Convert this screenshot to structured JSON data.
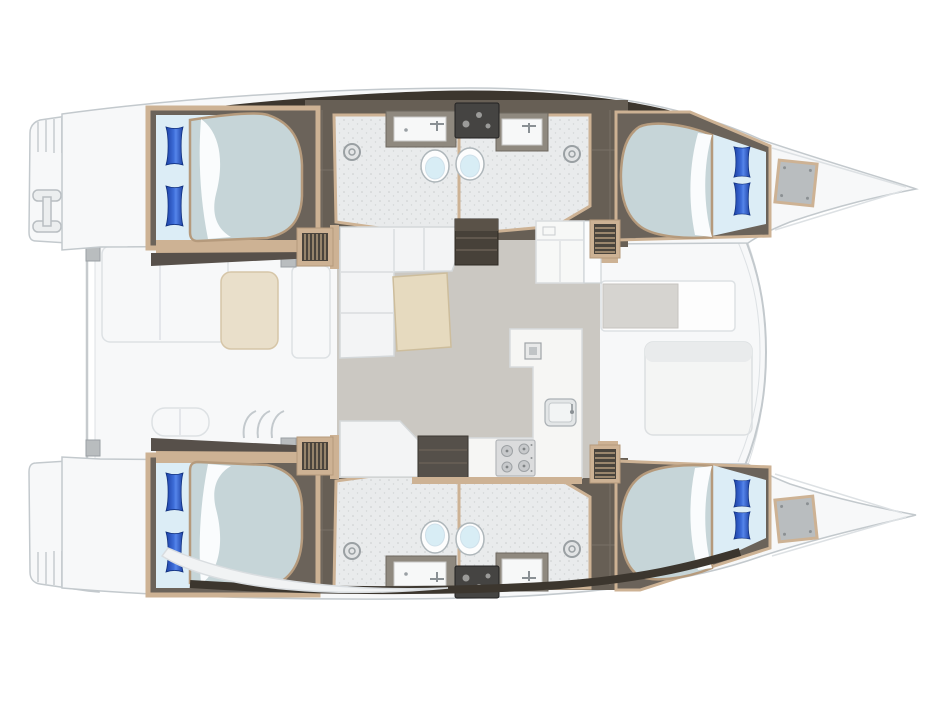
{
  "palette": {
    "bg": "#ffffff",
    "deck": "#f7f8f9",
    "deck2": "#f1f3f4",
    "outline": "#c3c9cd",
    "outline_soft": "#dde1e4",
    "hullstrip": "#3c362e",
    "floor_dark": "#675f55",
    "floor_dark2": "#57504a",
    "wood": "#cdb294",
    "wood_dark": "#b59a7c",
    "bath_floor": "#e9ebec",
    "fixture_frame": "#8f897f",
    "sink_white": "#f7f8f8",
    "toilet_white": "#fdfdfd",
    "toilet_bowl": "#d8edf5",
    "appliance_dark": "#454442",
    "knob_gray": "#9b9b99",
    "bed_mattress": "#c6d5d8",
    "bed_mattress_edge": "#9fb4b8",
    "bed_head": "#dcedf6",
    "pillow_dark": "#1c41a4",
    "pillow_mid": "#3d6cd8",
    "pillow_light": "#5585ea",
    "salon_floor": "#cbc8c2",
    "sofa": "#f3f4f5",
    "sofa_edge": "#d4d8da",
    "table_wood": "#e6dabf",
    "counter": "#f6f6f4",
    "stove_body": "#dbdcdd",
    "burner": "#c7c9cb",
    "burner_ring": "#9da1a4",
    "pad_inner": "#d6d4d0",
    "cushion_tan": "#e9dfca",
    "locker_gray": "#b9bdbf",
    "steps_dark": "#4a443c",
    "steps_line": "#c9ae8a",
    "drain_fill": "#e2e4e5",
    "drain_ring": "#9aa0a3"
  },
  "diagram": {
    "kind": "catamaran floor plan, top view, bows to the right",
    "hulls": 2,
    "cabins": [
      {
        "id": "port-aft-cabin",
        "bed": "double",
        "pillows": 2
      },
      {
        "id": "port-forward-cabin",
        "bed": "double",
        "pillows": 2
      },
      {
        "id": "starboard-aft-cabin",
        "bed": "double",
        "pillows": 2
      },
      {
        "id": "starboard-forward-cabin",
        "bed": "double",
        "pillows": 2
      }
    ],
    "heads": [
      {
        "id": "port-aft-head",
        "fixtures": [
          "toilet",
          "sink-vanity",
          "shower-drain"
        ]
      },
      {
        "id": "port-forward-head",
        "fixtures": [
          "toilet",
          "sink-vanity",
          "shower-drain"
        ]
      },
      {
        "id": "starboard-aft-head",
        "fixtures": [
          "toilet",
          "sink-vanity",
          "shower-drain"
        ]
      },
      {
        "id": "starboard-forward-head",
        "fixtures": [
          "toilet",
          "sink-vanity",
          "shower-drain"
        ]
      }
    ],
    "salon": [
      "l-shaped-sofa",
      "table",
      "nav-steps",
      "galley-counter",
      "stove-4-burner",
      "sink",
      "fridge-counter"
    ],
    "exterior": [
      "cockpit-bench",
      "swim-ladder",
      "transom-platforms",
      "foredeck-lounge",
      "sun-pad",
      "anchor-lockers"
    ]
  }
}
